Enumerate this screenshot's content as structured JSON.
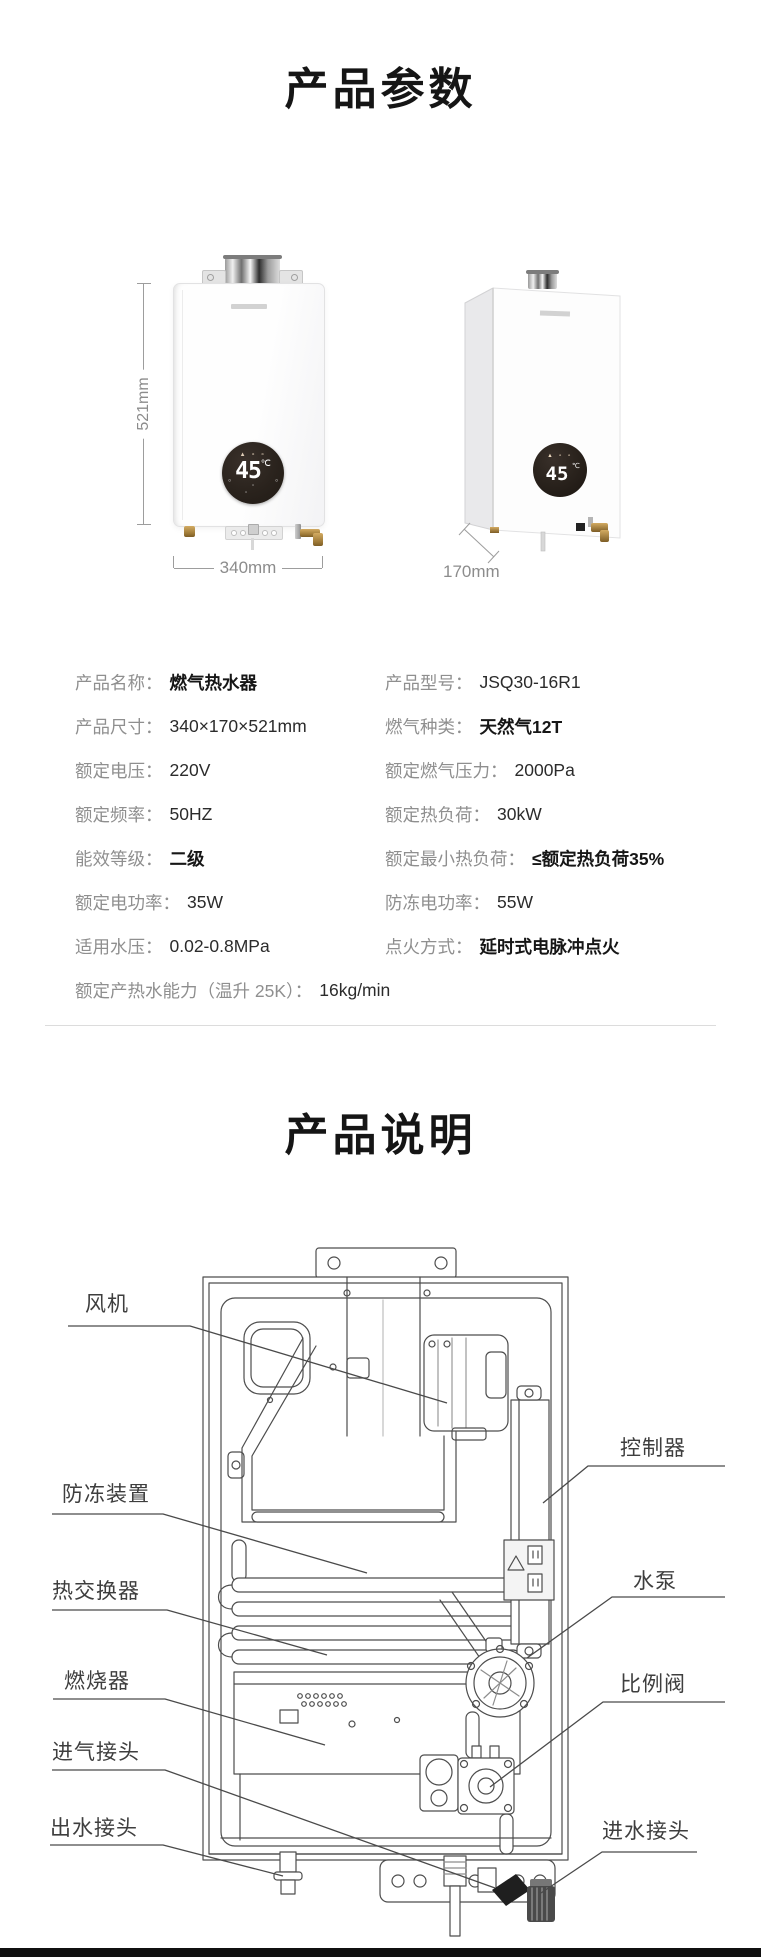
{
  "sections": {
    "parameters_title": "产品参数",
    "description_title": "产品说明"
  },
  "product_views": {
    "front": {
      "display": {
        "value": "45",
        "unit": "℃",
        "top_icons": "▲ ∘ ∘",
        "side_left_icon": "∘",
        "side_right_icon": "∘",
        "bottom_icons": "∘ ∘"
      },
      "dim_height": "521mm",
      "dim_width": "340mm"
    },
    "side": {
      "display": {
        "value": "45",
        "unit": "℃",
        "top_icons": "▲ ∘ ∘"
      },
      "dim_depth": "170mm"
    }
  },
  "specs": {
    "left": [
      {
        "label": "产品名称：",
        "value": "燃气热水器"
      },
      {
        "label": "产品尺寸：",
        "value": "340×170×521mm"
      },
      {
        "label": "额定电压：",
        "value": "220V"
      },
      {
        "label": "额定频率：",
        "value": "50HZ"
      },
      {
        "label": "能效等级：",
        "value": "二级"
      },
      {
        "label": "额定电功率：",
        "value": "35W"
      },
      {
        "label": "适用水压：",
        "value": "0.02-0.8MPa"
      },
      {
        "label": "额定产热水能力（温升 25K）：",
        "value": "16kg/min"
      }
    ],
    "right": [
      {
        "label": "产品型号：",
        "value": "JSQ30-16R1"
      },
      {
        "label": "燃气种类：",
        "value": "天然气12T"
      },
      {
        "label": "额定燃气压力：",
        "value": "2000Pa"
      },
      {
        "label": "额定热负荷：",
        "value": "30kW"
      },
      {
        "label": "额定最小热负荷：",
        "value": "≤额定热负荷35%"
      },
      {
        "label": "防冻电功率：",
        "value": "55W"
      },
      {
        "label": "点火方式：",
        "value": "延时式电脉冲点火"
      }
    ]
  },
  "diagram": {
    "labels": {
      "fan": "风机",
      "antifreeze": "防冻装置",
      "heat_exchanger": "热交换器",
      "burner": "燃烧器",
      "gas_inlet": "进气接头",
      "water_outlet": "出水接头",
      "controller": "控制器",
      "water_pump": "水泵",
      "proportional_valve": "比例阀",
      "water_inlet": "进水接头"
    }
  },
  "colors": {
    "text_primary": "#2b2b2b",
    "text_label": "#8f8f8f",
    "title": "#151515",
    "diagram_stroke": "#4d4d4d",
    "display_bg": "#2a231d",
    "brass": "#b08d4f",
    "bottom_bar": "#101010"
  }
}
